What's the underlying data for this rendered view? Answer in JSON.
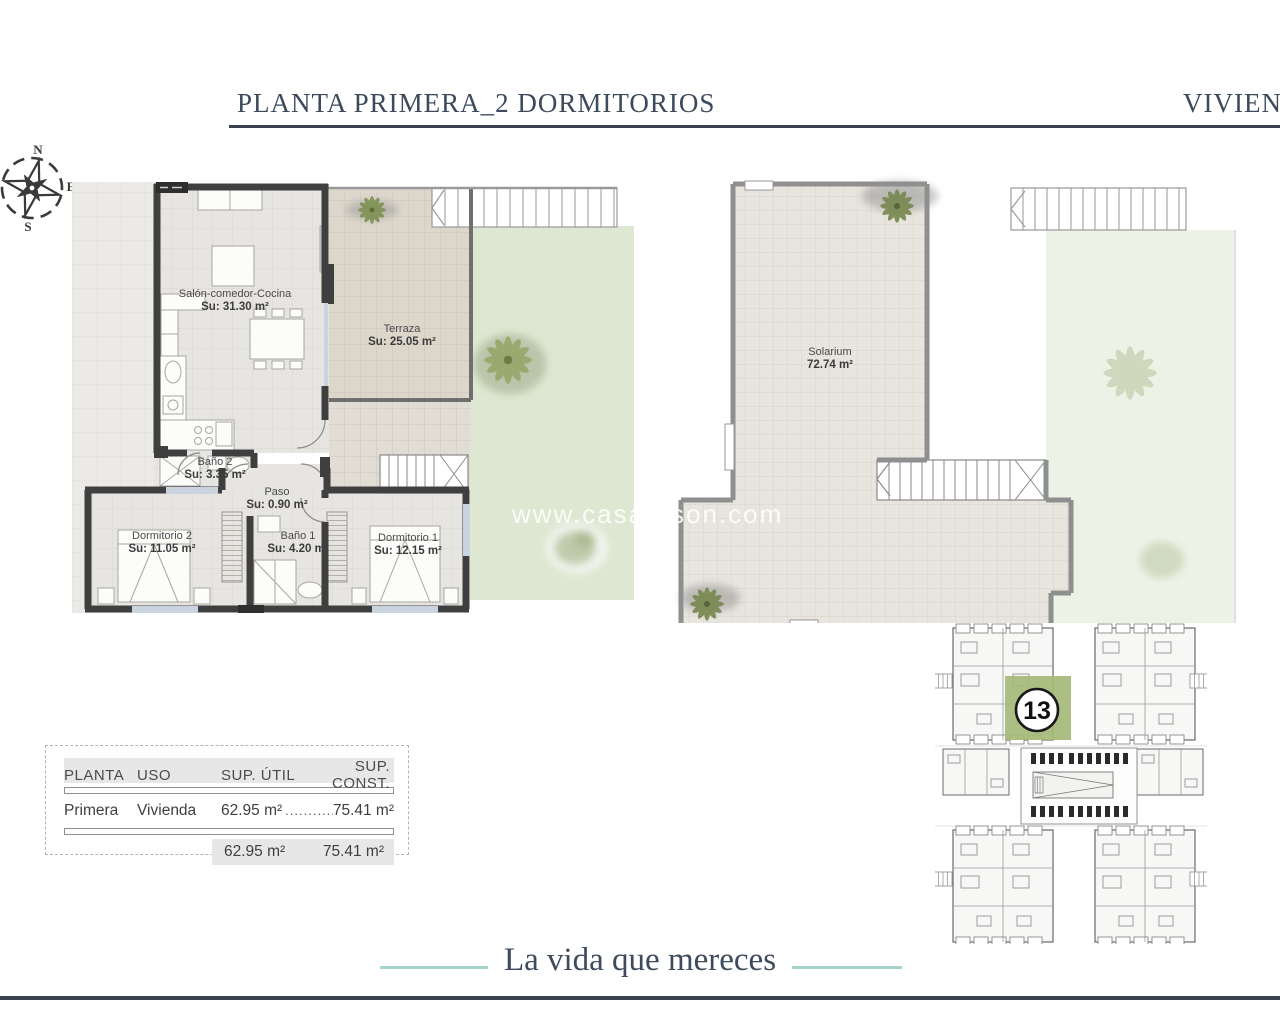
{
  "header": {
    "title_left": "PLANTA PRIMERA_2 DORMITORIOS",
    "title_right": "VIVIENDA"
  },
  "compass": {
    "n": "N",
    "e": "E",
    "s": "S",
    "w": "W"
  },
  "floor_plan": {
    "rooms": [
      {
        "name": "Salón-comedor-Cocina",
        "area": "Su: 31.30 m²"
      },
      {
        "name": "Terraza",
        "area": "Su: 25.05 m²"
      },
      {
        "name": "Baño 2",
        "area": "Su: 3.35 m²"
      },
      {
        "name": "Paso",
        "area": "Su: 0.90 m²"
      },
      {
        "name": "Dormitorio 2",
        "area": "Su: 11.05 m²"
      },
      {
        "name": "Baño 1",
        "area": "Su: 4.20 m²"
      },
      {
        "name": "Dormitorio 1",
        "area": "Su: 12.15 m²"
      }
    ]
  },
  "solarium_plan": {
    "rooms": [
      {
        "name": "Solarium",
        "area": "72.74 m²"
      }
    ]
  },
  "watermark": {
    "left": "www.casas",
    "right": "son.com"
  },
  "key_plan": {
    "unit_number": "13",
    "highlight_color": "#a5ba77"
  },
  "table": {
    "headers": [
      "PLANTA",
      "USO",
      "SUP. ÚTIL",
      "SUP. CONST."
    ],
    "rows": [
      {
        "planta": "Primera",
        "uso": "Vivienda",
        "sup_util": "62.95 m²",
        "leader": "..............",
        "sup_const": "75.41 m²"
      }
    ],
    "totals": {
      "sup_util": "62.95 m²",
      "sup_const": "75.41 m²"
    }
  },
  "footer": {
    "tagline": "La vida que mereces"
  },
  "colors": {
    "title": "#3d4a5c",
    "rule": "#39434f",
    "teal": "#a6d3ce",
    "wall": "#3f3f3f",
    "highlight_green": "#a5ba77",
    "lawn": "#dde7d1"
  }
}
